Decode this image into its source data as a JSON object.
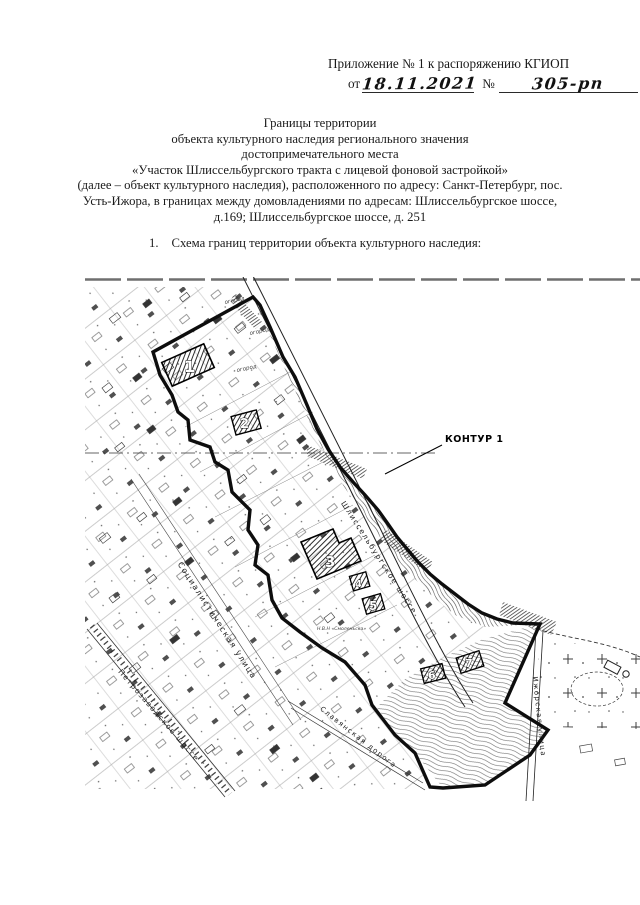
{
  "doc": {
    "header": {
      "line1": "Приложение № 1 к распоряжению КГИОП",
      "from_label": "от",
      "date_value": "18.11.2021",
      "number_label": "№",
      "number_value": "305-рп"
    },
    "title_lines": [
      "Границы территории",
      "объекта культурного наследия регионального значения",
      "достопримечательного места",
      "«Участок Шлиссельбургского тракта с лицевой фоновой застройкой»",
      "(далее – объект культурного наследия), расположенного по адресу: Санкт-Петербург, пос.",
      "Усть-Ижора, в границах между домовладениями по адресам: Шлиссельбургское шоссе,",
      "д.169; Шлиссельбургское шоссе, д. 251"
    ],
    "list_item": {
      "number": "1.",
      "text": "Схема границ территории объекта культурного наследия:"
    }
  },
  "map": {
    "contour_label": "КОНТУР 1",
    "streets": {
      "shlisselburgskoe": "Шлиссельбургское шоссе",
      "sotsialisticheskaya": "Социалистическая улица",
      "petrozavodskoe": "Петрозаводское шоссе",
      "izhorskaya": "Ижорская улица",
      "slavyanskaya": "Славянская дорога"
    },
    "buildings": [
      "1",
      "2",
      "3",
      "4",
      "5",
      "6",
      "7"
    ],
    "area_labels": {
      "ogorod_1": "огород",
      "ogorod_2": "огород",
      "ogorod_3": "огород",
      "note": "Н.В.Н «Смоленьска»"
    },
    "colors": {
      "boundary": "#0d0d0d",
      "map_ink": "#333333"
    }
  }
}
